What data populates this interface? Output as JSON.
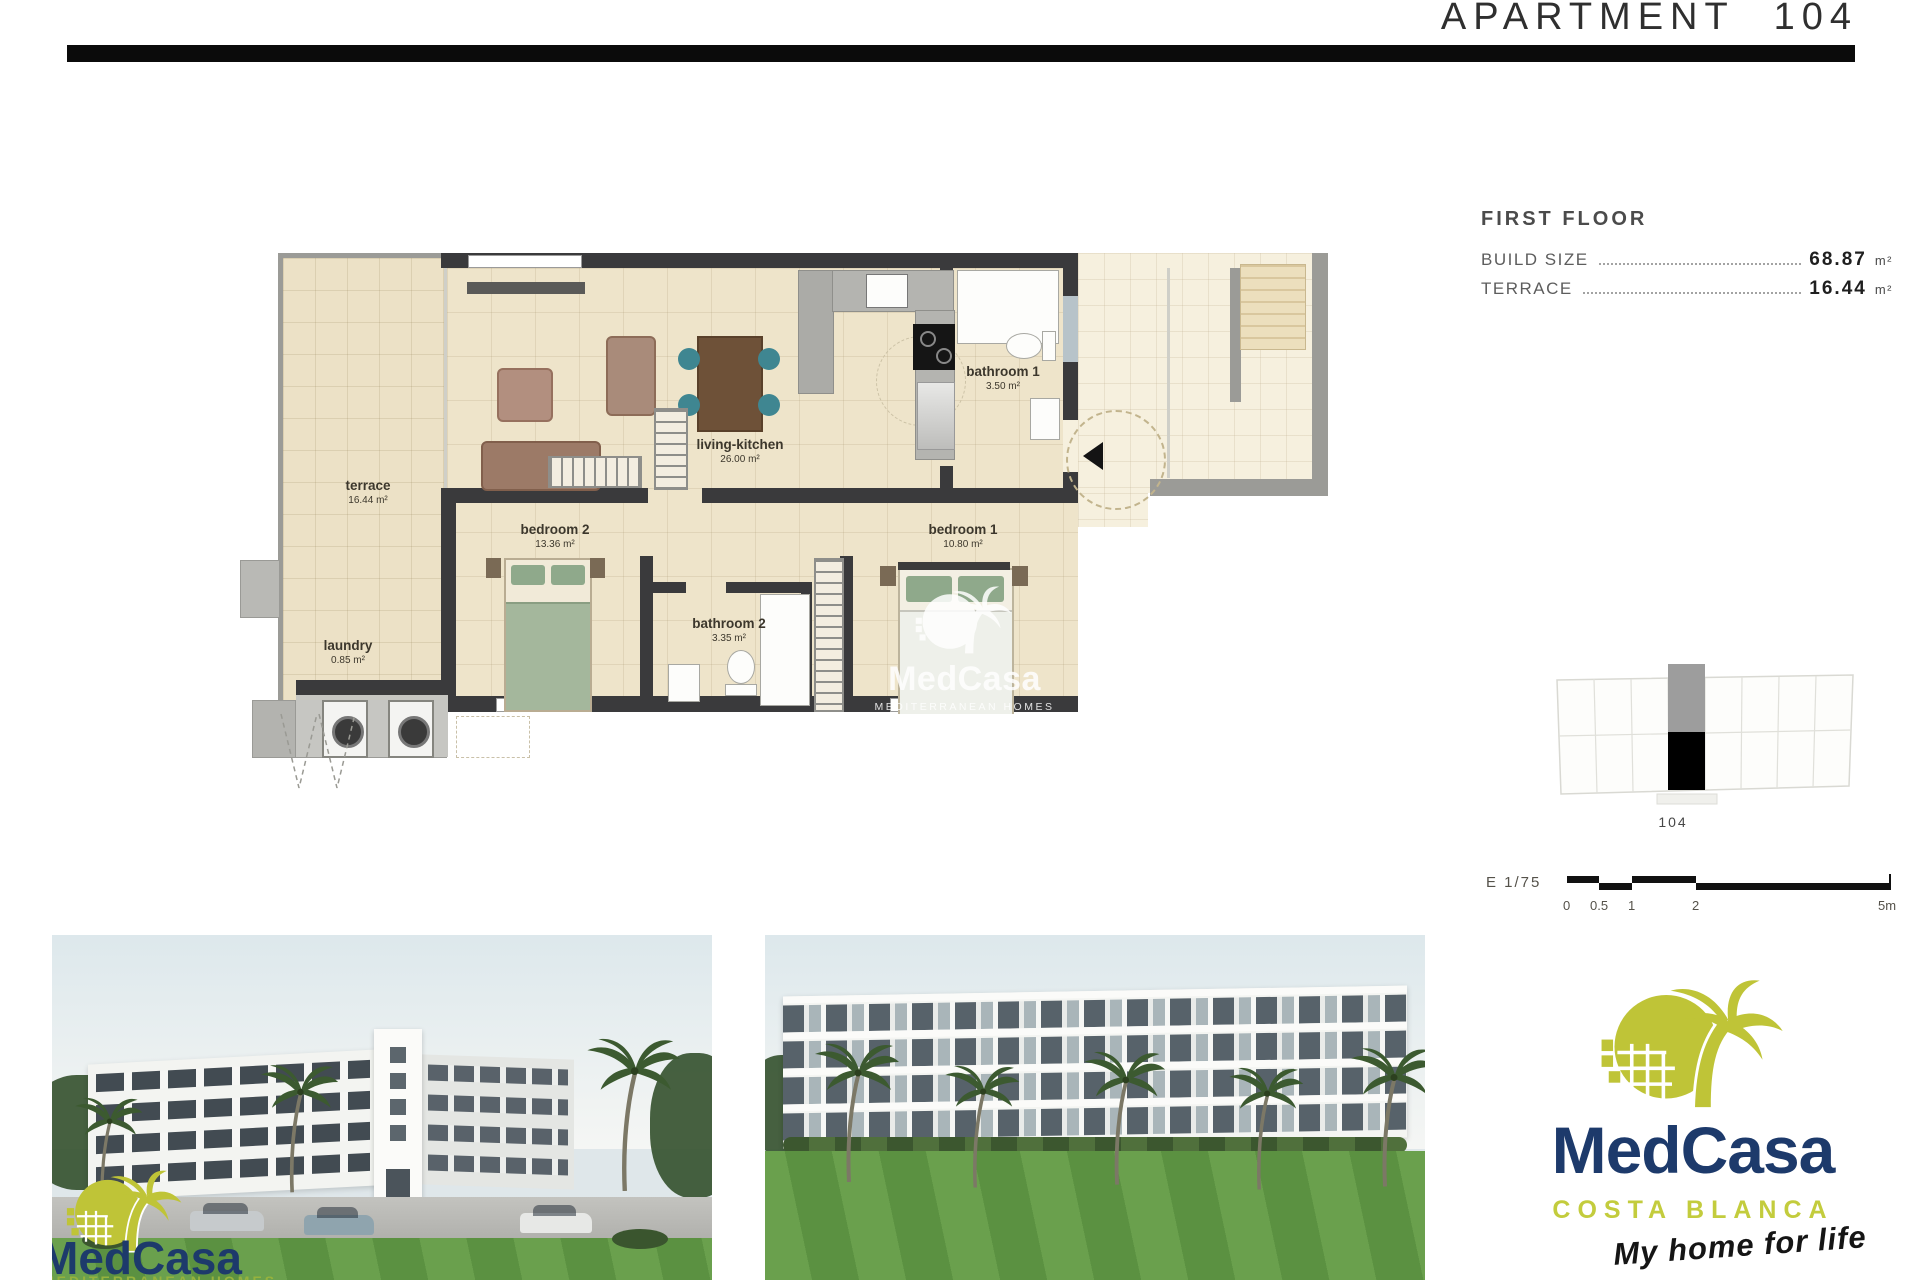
{
  "header": {
    "title": "APARTMENT 104"
  },
  "info_panel": {
    "floor_label": "FIRST FLOOR",
    "rows": [
      {
        "label": "BUILD SIZE",
        "value": "68.87",
        "unit": "m²"
      },
      {
        "label": "TERRACE",
        "value": "16.44",
        "unit": "m²"
      }
    ]
  },
  "floor_plan": {
    "rooms": {
      "terrace": {
        "name": "terrace",
        "area": "16.44 m²"
      },
      "laundry": {
        "name": "laundry",
        "area": "0.85 m²"
      },
      "bedroom2": {
        "name": "bedroom 2",
        "area": "13.36 m²"
      },
      "bathroom2": {
        "name": "bathroom 2",
        "area": "3.35 m²"
      },
      "bedroom1": {
        "name": "bedroom 1",
        "area": "10.80 m²"
      },
      "bathroom1": {
        "name": "bathroom 1",
        "area": "3.50 m²"
      },
      "living": {
        "name": "living-kitchen",
        "area": "26.00 m²"
      }
    }
  },
  "locator": {
    "unit_label": "104"
  },
  "scale_bar": {
    "label": "E 1/75",
    "ticks": [
      "0",
      "0.5",
      "1",
      "2",
      "5m"
    ]
  },
  "brand": {
    "name": "MedCasa",
    "region": "COSTA BLANCA",
    "slogan": "My home for life",
    "homes_tagline": "MEDITERRANEAN HOMES",
    "colors": {
      "olive": "#bfc437",
      "navy": "#1d3a6b"
    }
  }
}
